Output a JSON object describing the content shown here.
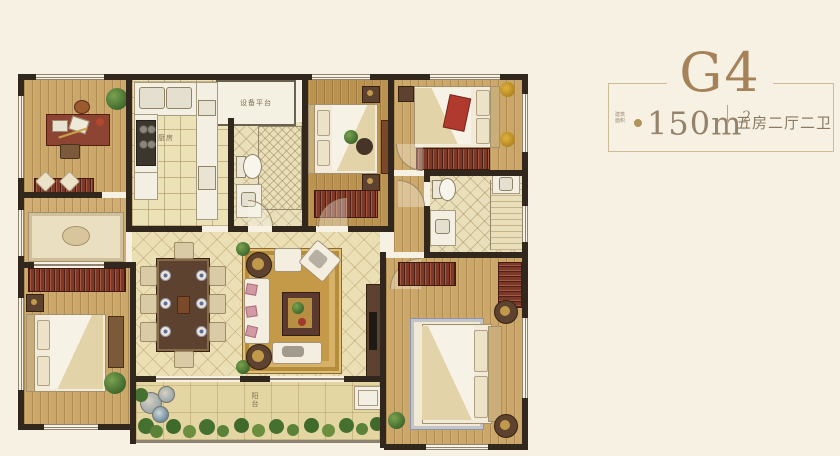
{
  "header": {
    "title": "G4",
    "area_prefix_line1": "建筑",
    "area_prefix_line2": "面积",
    "area_value": "150",
    "area_unit": "m",
    "area_sup": "2",
    "spec": "五房二厅二卫"
  },
  "plan": {
    "labels": {
      "equipment_platform": "设备平台",
      "kitchen": "厨房",
      "balcony": "阳台"
    },
    "colors": {
      "accent_gold": "#a5825a",
      "wall": "#31271d",
      "wood_floor": "#cba76a",
      "living_tile": "#ebdfb6",
      "balcony_tile": "#e4d6a3",
      "furniture_red": "#7c392a",
      "bed_white": "#f2ebd9",
      "rug_gold": "#c49a48",
      "plant_green": "#4d7a36",
      "page_background": "#f7f1e3"
    }
  }
}
